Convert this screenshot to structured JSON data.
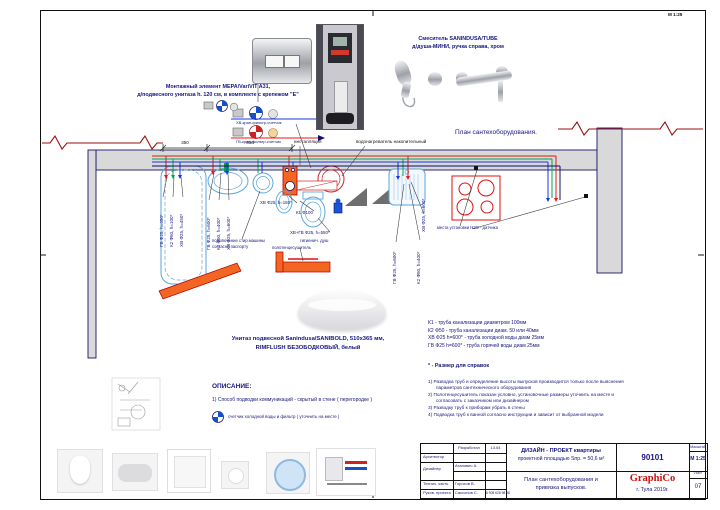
{
  "sheet": {
    "corner_mark": "М 1:25",
    "plan_title": "План сантехоборудования."
  },
  "products": {
    "mount_line1": "Монтажный элемент MEPA/VariVIT A31,",
    "mount_line2": "д/подвесного унитаза h. 120 см, в комплекте с крепежом \"Е\"",
    "mixer_line1": "Смеситель SANINDUSA/TUBE",
    "mixer_line2": "д/душа-МИНИ, ручка справа, хром",
    "toilet_line1": "Унитаз подвесной Sanindusa/SANIBOLD, 510х365 мм,",
    "toilet_line2": "RIMFLUSH БЕЗОБОДКОВЫЙ, белый"
  },
  "schematic": {
    "cold_label": "ХВ-кран-фильтр-счетчик",
    "hot_label": "ГВ-кран-фильтр-счетчик"
  },
  "plan": {
    "dim_350": "350",
    "dim_650": "650",
    "installation": "инсталляция",
    "water_heater": "водонагреватель накопительный",
    "tub_gv": "ГВ Ф25, h=450*",
    "tub_k2": "К2 Ф50, h=100*",
    "tub_xv": "ХВ Ф25, h=450*",
    "basin_gv": "ГВ Ф25, h=600*",
    "basin_k2": "К2 Ф50, h=400*",
    "basin_xv": "ХВ Ф25, h=600*",
    "washer_note1": "подключение стир.машины",
    "washer_note2": "согласно паспорту",
    "xv_150": "ХВ Ф25, h=150*",
    "k1_100": "К1 Ф100",
    "xvgv_550": "ХВ+ГВ Ф25, h=550*",
    "hygienic": "гигиенич. душ",
    "towel": "полотенцесушитель",
    "sink_xv": "ХВ Ф25, h=600*",
    "sink_gv": "ГВ Ф25, h=600*",
    "sink_k2": "К2 Ф50, h=400*",
    "sensor": "места установки Н2О - датчика"
  },
  "description": {
    "title": "ОПИСАНИЕ:",
    "item1": "1) Способ подводки коммуникаций - скрытый в стене ( перегородке )",
    "meter_note": "счетчик холодной воды и фильтр ( уточнить на месте )"
  },
  "legend": {
    "l1": "К1 - труба канализации диаметром 100мм",
    "l2": "К2 Ф50 - труба канализации диам. 50 или 40мм",
    "l3": "ХВ Ф25 h=600* - труба холодной воды диам 25мм",
    "l4": "ГВ Ф25 h=600* - труба горячей воды диам 25мм",
    "ref": "*  - Размер для справок",
    "n1": "1) Разводка труб и определение высоты выпусков производится только после выяснения параметров сантехнического оборудования",
    "n2": "2) Полотенцесушитель показан условно, установочные размеры уточнить на месте и согласовать с заказчиком или дизайнером",
    "n3": "3) Разводку труб к приборам убрать в стены",
    "n4": "4) Подводка труб к ванной согласно инструкции и зависит от выбранной модели"
  },
  "titleblock": {
    "developed": "Разработал",
    "date": "13.04",
    "role1": "Архитектор",
    "role2": "Дизайнер",
    "role3": "Технич. часть",
    "role4": "Руков. проекта",
    "name2": "Атанович А.",
    "name3": "Горохов В.",
    "name4": "Саксонов С.",
    "phone": "8 905 628 98 98",
    "project_line1": "ДИЗАЙН - ПРОЕКТ квартиры",
    "project_line2": "проектной площадью Sпр. = 50,6 м²",
    "sheet_line1": "План сантехоборудования и",
    "sheet_line2": "привязка выпусков.",
    "code": "90101",
    "brand": "GraphiCo",
    "city": "г. Тула  2019г.",
    "scale_label": "Масштаб",
    "scale": "М 1:25",
    "list_label": "Лист",
    "list_no": "07"
  },
  "colors": {
    "cold": "#1437e8",
    "hot": "#e81515",
    "green": "#00a651",
    "sewer": "#10106e",
    "wall_fill": "#d9d9d9",
    "fixture": "#5aa7dc",
    "orange": "#f26522",
    "accent": "#cc1111"
  }
}
